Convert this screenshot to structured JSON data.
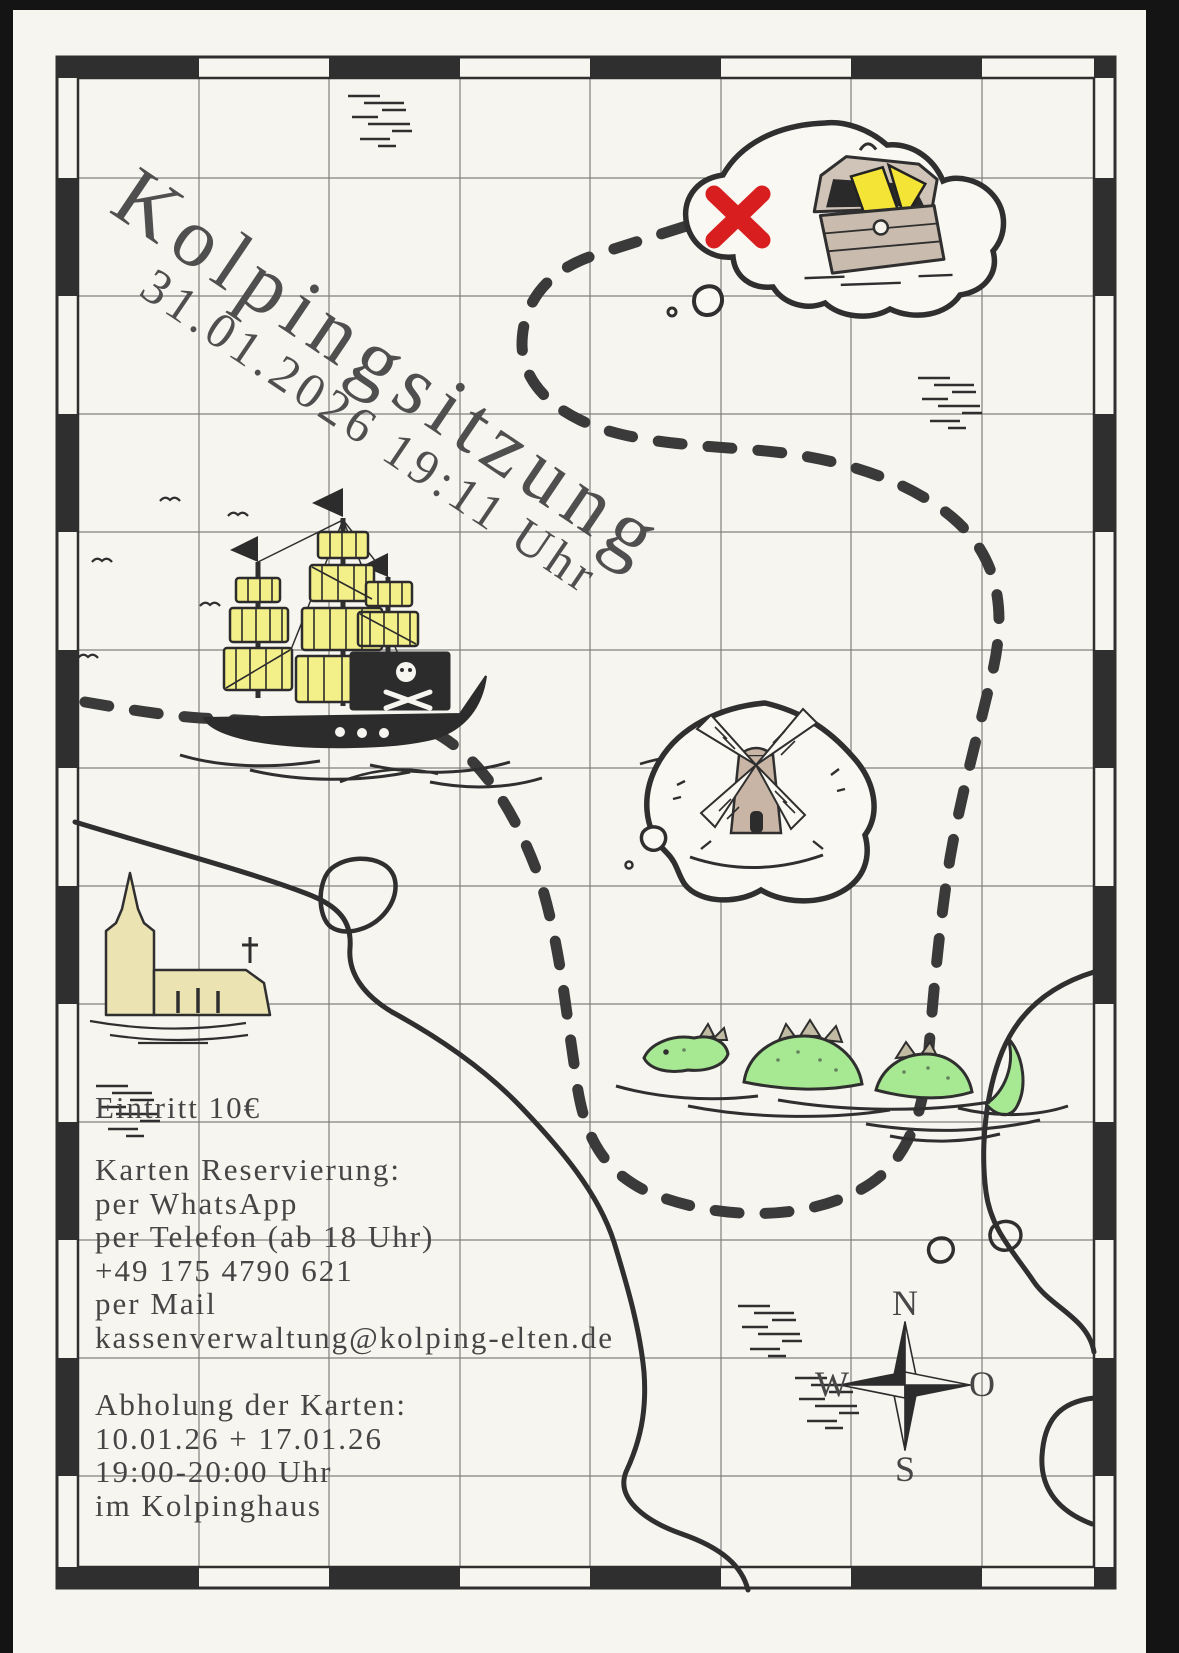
{
  "poster": {
    "title": "Kolpingsitzung",
    "datetime": "31.01.2026 19:11 Uhr",
    "admission": "Eintritt 10€",
    "reservation": {
      "heading": "Karten Reservierung:",
      "lines": [
        "per WhatsApp",
        "per Telefon (ab 18 Uhr)",
        "+49 175 4790 621",
        "per Mail",
        "kassenverwaltung@kolping-elten.de"
      ]
    },
    "pickup": {
      "heading": "Abholung der Karten:",
      "lines": [
        "10.01.26 + 17.01.26",
        "19:00-20:00 Uhr",
        "im Kolpinghaus"
      ]
    },
    "compass": {
      "north": "N",
      "east": "O",
      "south": "S",
      "west": "W"
    },
    "icons": {
      "pirate_ship": "sailing-ship-with-skull-flag",
      "treasure_chest": "open-chest-with-gold",
      "red_x": "x-marks-the-spot",
      "windmill": "windmill-on-island",
      "church": "church-with-spire",
      "sea_serpent": "three-hump-serpent",
      "compass_rose": "four-point-star",
      "route": "dashed-treasure-path"
    },
    "colors": {
      "paper": "#f7f5ef",
      "ink": "#2f2f2f",
      "text": "#454545",
      "accent_red": "#d81e1e",
      "sail_yellow": "#f4f089",
      "gold_yellow": "#f4e436",
      "church_cream": "#ece3b2",
      "windmill_tan": "#c9b5a5",
      "serpent_green": "#a7e892",
      "chest_tan": "#c9bbad"
    }
  }
}
